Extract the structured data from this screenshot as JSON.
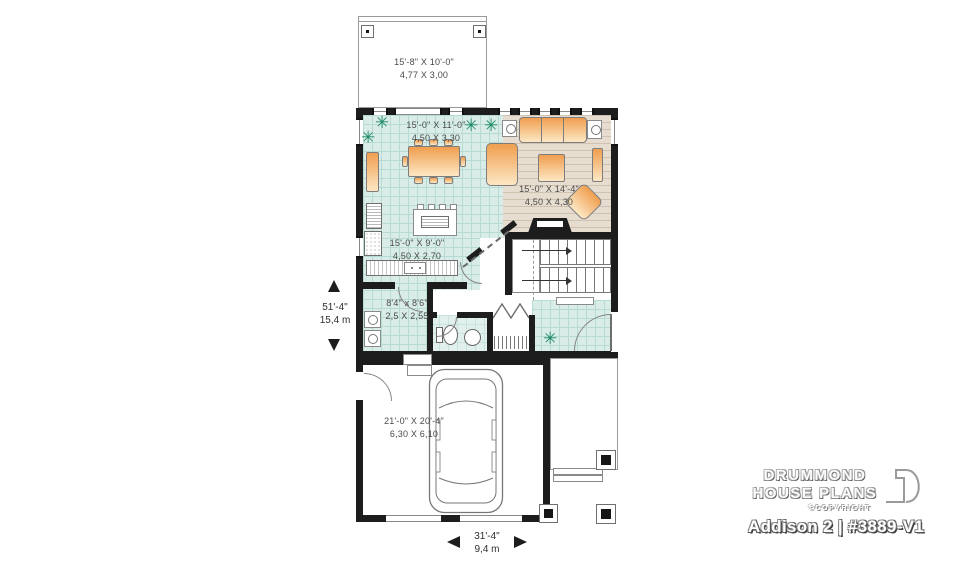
{
  "title_block": {
    "brand_line1": "DRUMMOND",
    "brand_line2": "HOUSE PLANS",
    "copyright": "©COPYRIGHT",
    "plan_title": "Addison 2 | #3889-V1"
  },
  "dimensions": {
    "depth_imperial": "51'-4\"",
    "depth_metric": "15,4 m",
    "width_imperial": "31'-4\"",
    "width_metric": "9,4 m"
  },
  "rooms": {
    "deck": {
      "imperial": "15'-8\" X 10'-0\"",
      "metric": "4,77 X 3,00"
    },
    "dining": {
      "imperial": "15'-0\" X 11'-0\"",
      "metric": "4,50 X 3,30"
    },
    "living": {
      "imperial": "15'-0\" X 14'-4\"",
      "metric": "4,50 X 4,30"
    },
    "kitchen": {
      "imperial": "15'-0\" X 9'-0\"",
      "metric": "4,50 X 2,70"
    },
    "laundry": {
      "imperial": "8'4\" x 8'6\"",
      "metric": "2,5 X 2,55"
    },
    "garage": {
      "imperial": "21'-0\" X 20'-4\"",
      "metric": "6,30 X 6,10"
    }
  },
  "symbols": {
    "plant": "✳"
  },
  "colors": {
    "wall": "#1d1d1d",
    "tile": "#d9ece8",
    "tileGrid": "#b7dad3",
    "wood": "#e6dccf",
    "woodLine": "#cfc2b0",
    "furnA": "#f0a153",
    "furnB": "#fce4bf",
    "green": "#1a8a63",
    "lineGray": "#8a8a8a",
    "textGray": "#4a4a4a"
  }
}
